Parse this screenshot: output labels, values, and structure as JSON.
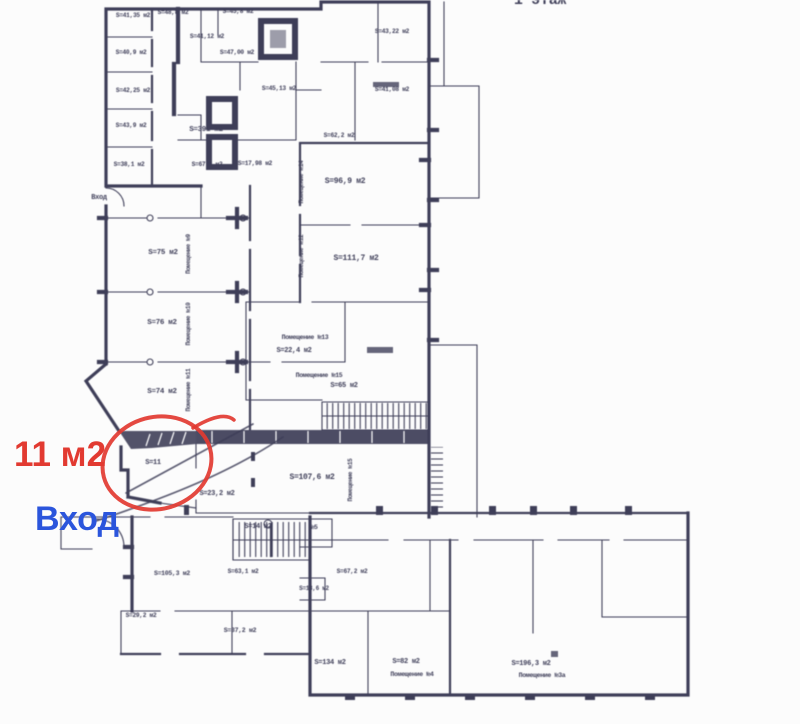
{
  "title": {
    "floor": "1 этаж"
  },
  "annotations": {
    "area": "11 м2",
    "entrance": "Вход"
  },
  "colors": {
    "ink": "#373752",
    "red": "#e23a31",
    "blue": "#2b55dc",
    "paper": "#fcfcfc"
  },
  "plan": {
    "labels": {
      "l1": {
        "text": "S=41,35 м2"
      },
      "l2": {
        "text": "S=40,9 м2"
      },
      "l3": {
        "text": "S=42,25 м2"
      },
      "l4": {
        "text": "S=43,9 м2"
      },
      "l5": {
        "text": "S=38,1 м2"
      },
      "l6": {
        "text": "S=48,8 м2"
      },
      "l7": {
        "text": "S=45,8 м2"
      },
      "l8": {
        "text": "S=41,12 м2"
      },
      "l9": {
        "text": "S=47,00 м2"
      },
      "l10": {
        "text": "S=45,13 м2"
      },
      "l11": {
        "text": "S=43,22 м2"
      },
      "l12": {
        "text": "S=41,08 м2"
      },
      "l13": {
        "text": "S=62,2 м2"
      },
      "l14": {
        "text": "S=391 м2"
      },
      "l15": {
        "text": "S=67,3 м2"
      },
      "l16": {
        "text": "S=17,98 м2"
      },
      "l17": {
        "text": "Вход"
      },
      "l18": {
        "text": "S=75 м2"
      },
      "l19": {
        "text": "S=76 м2"
      },
      "l20": {
        "text": "S=74 м2"
      },
      "l21": {
        "text": "S=96,9 м2"
      },
      "l22": {
        "text": "S=111,7 м2"
      },
      "l23": {
        "text": "Помещение №13"
      },
      "l24": {
        "text": "S=22,4 м2"
      },
      "l25": {
        "text": "Помещение №15"
      },
      "l26": {
        "text": "S=65 м2"
      },
      "l27": {
        "text": "S=11"
      },
      "l28": {
        "text": "S=23,2 м2"
      },
      "l29": {
        "text": "S=107,6 м2"
      },
      "l30": {
        "text": "S=14 м2"
      },
      "l31": {
        "text": "№5"
      },
      "l32": {
        "text": "S=105,3 м2"
      },
      "l33": {
        "text": "S=29,2 м2"
      },
      "l34": {
        "text": "S=37,2 м2"
      },
      "l35": {
        "text": "S=63,1 м2"
      },
      "l36": {
        "text": "S=67,2 м2"
      },
      "l37": {
        "text": "S=13,6 м2"
      },
      "l38": {
        "text": "S=134 м2"
      },
      "l39": {
        "text": "S=82 м2"
      },
      "l40": {
        "text": "Помещение №4"
      },
      "l41": {
        "text": "S=196,3 м2"
      },
      "l42": {
        "text": "Помещение №3а"
      },
      "v1": {
        "text": "Помещение №9"
      },
      "v2": {
        "text": "Помещение №10"
      },
      "v3": {
        "text": "Помещение №11"
      },
      "v4": {
        "text": "Помещение №14"
      },
      "v5": {
        "text": "Помещение №12"
      },
      "v6": {
        "text": "Помещение №15"
      }
    }
  }
}
